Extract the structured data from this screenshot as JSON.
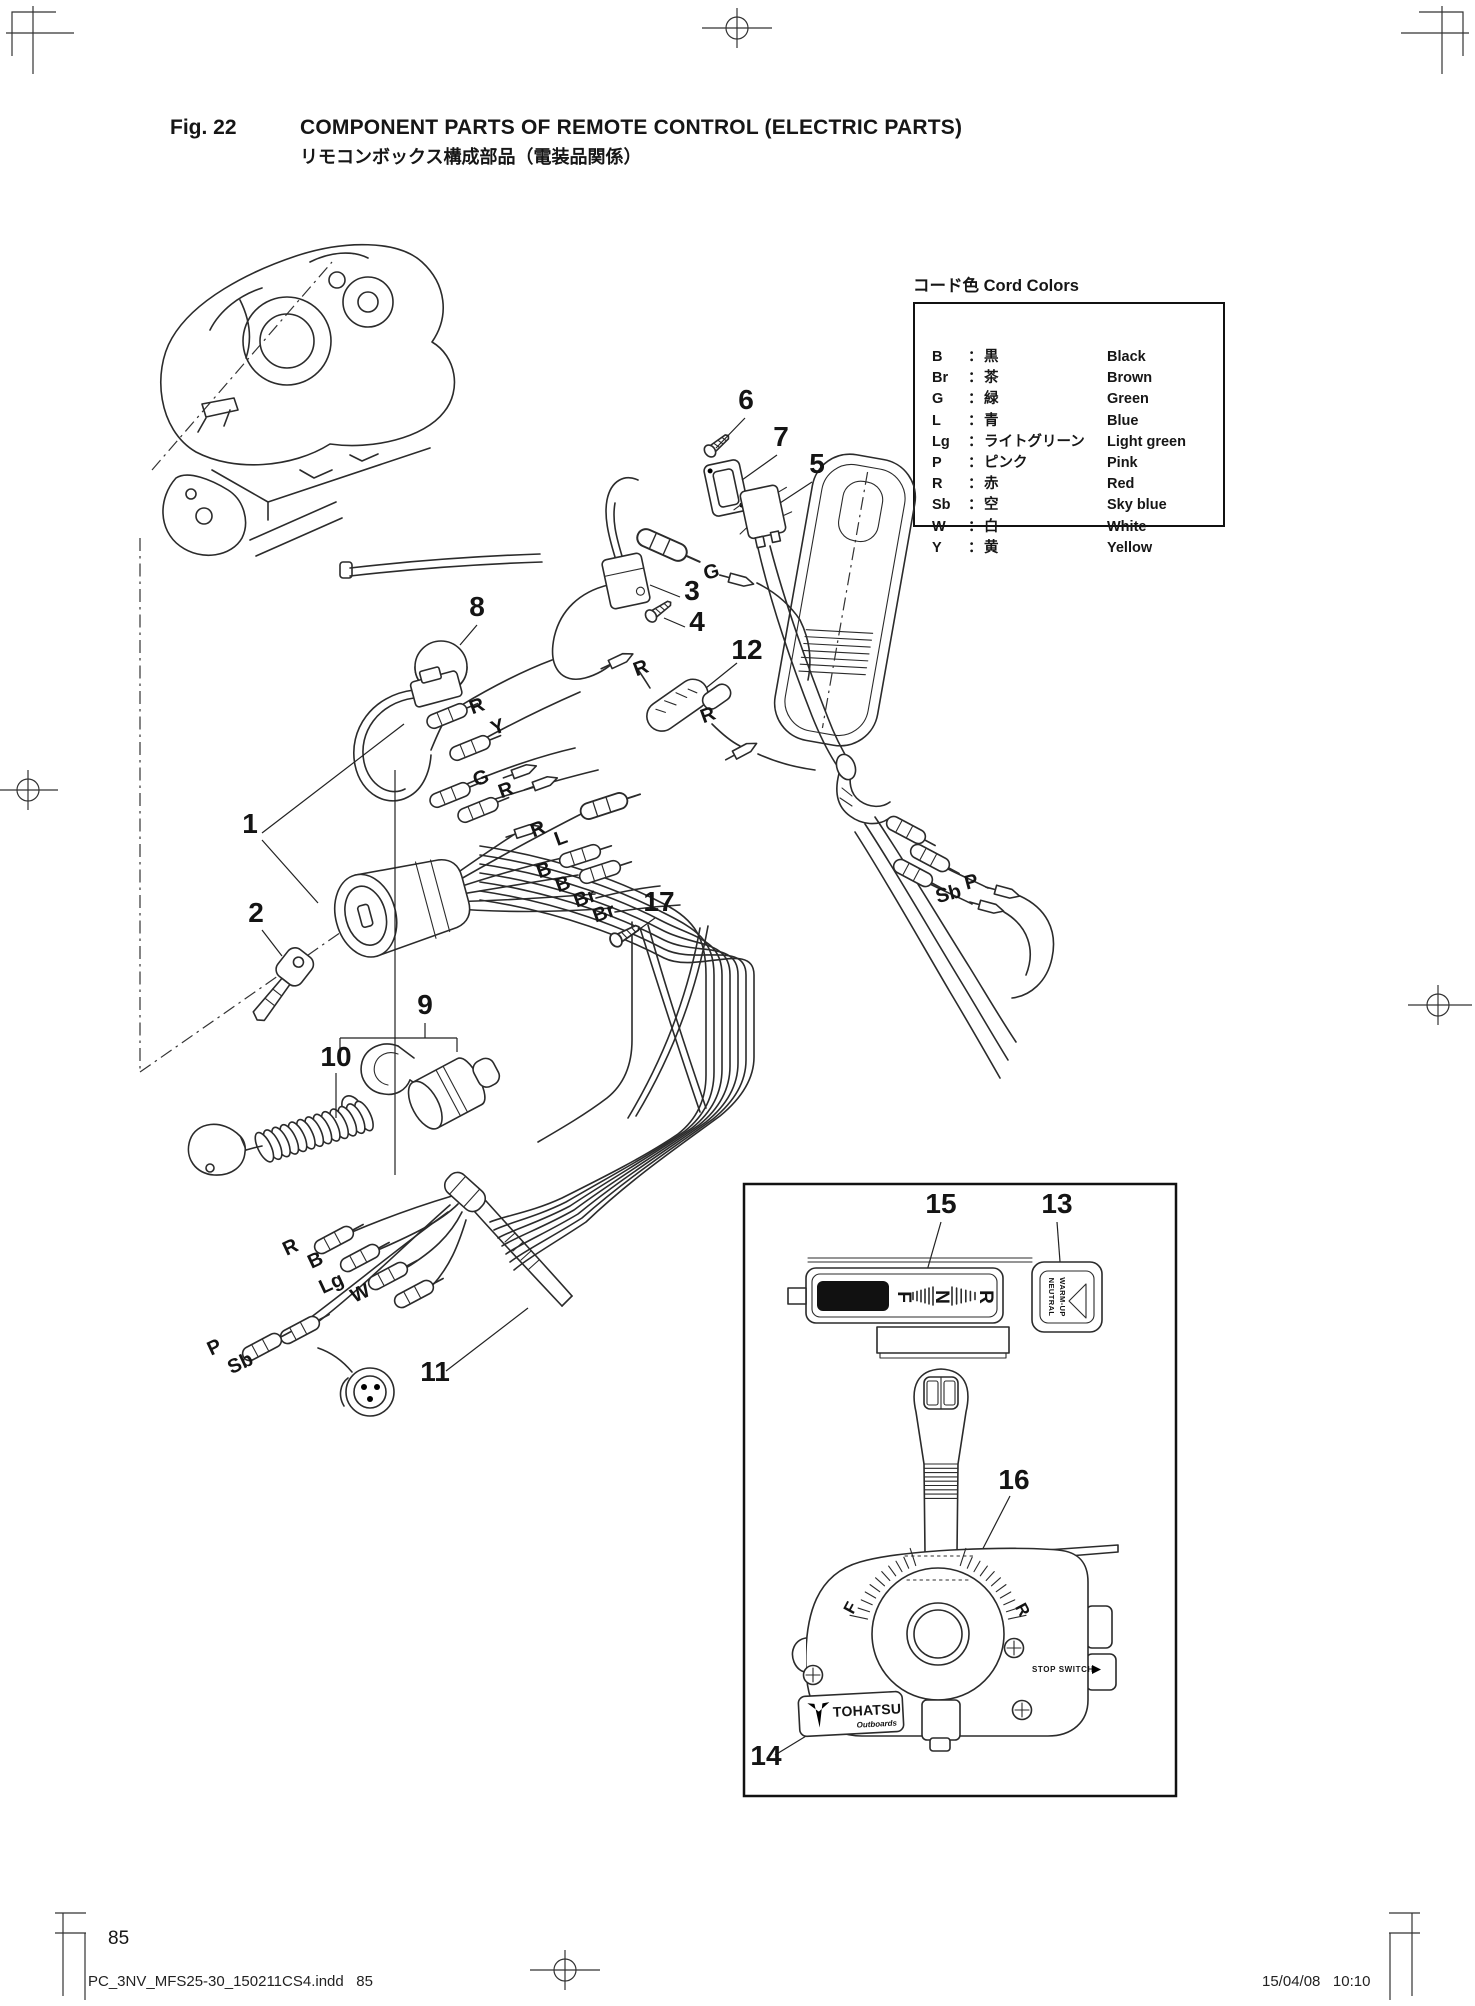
{
  "page": {
    "fig_label": "Fig. 22",
    "title": "COMPONENT PARTS OF REMOTE CONTROL (ELECTRIC PARTS)",
    "subtitle_jp": "リモコンボックス構成部品（電装品関係）",
    "page_number": "85",
    "footer_left": "PC_3NV_MFS25-30_150211CS4.indd   85",
    "footer_right": "15/04/08   10:10"
  },
  "cord_colors": {
    "title_jp": "コード色",
    "title_en": "Cord Colors",
    "sep": "：",
    "rows": [
      {
        "code": "B",
        "jp": "黒",
        "en": "Black"
      },
      {
        "code": "Br",
        "jp": "茶",
        "en": "Brown"
      },
      {
        "code": "G",
        "jp": "緑",
        "en": "Green"
      },
      {
        "code": "L",
        "jp": "青",
        "en": "Blue"
      },
      {
        "code": "Lg",
        "jp": "ライトグリーン",
        "en": "Light green"
      },
      {
        "code": "P",
        "jp": "ピンク",
        "en": "Pink"
      },
      {
        "code": "R",
        "jp": "赤",
        "en": "Red"
      },
      {
        "code": "Sb",
        "jp": "空",
        "en": "Sky blue"
      },
      {
        "code": "W",
        "jp": "白",
        "en": "White"
      },
      {
        "code": "Y",
        "jp": "黄",
        "en": "Yellow"
      }
    ]
  },
  "diagram": {
    "callouts": [
      {
        "n": "1",
        "x": 250,
        "y": 833
      },
      {
        "n": "2",
        "x": 256,
        "y": 922
      },
      {
        "n": "3",
        "x": 692,
        "y": 600
      },
      {
        "n": "4",
        "x": 697,
        "y": 631
      },
      {
        "n": "5",
        "x": 817,
        "y": 473
      },
      {
        "n": "6",
        "x": 746,
        "y": 409
      },
      {
        "n": "7",
        "x": 781,
        "y": 446
      },
      {
        "n": "8",
        "x": 477,
        "y": 616
      },
      {
        "n": "9",
        "x": 425,
        "y": 1014
      },
      {
        "n": "10",
        "x": 336,
        "y": 1066
      },
      {
        "n": "11",
        "x": 435,
        "y": 1381
      },
      {
        "n": "12",
        "x": 747,
        "y": 659
      },
      {
        "n": "13",
        "x": 1057,
        "y": 1213
      },
      {
        "n": "14",
        "x": 766,
        "y": 1765
      },
      {
        "n": "15",
        "x": 941,
        "y": 1213
      },
      {
        "n": "16",
        "x": 1014,
        "y": 1489
      },
      {
        "n": "17",
        "x": 659,
        "y": 911
      }
    ],
    "wire_labels": [
      {
        "t": "G",
        "x": 713,
        "y": 578,
        "r": -15
      },
      {
        "t": "R",
        "x": 479,
        "y": 712,
        "r": -20
      },
      {
        "t": "Y",
        "x": 500,
        "y": 733,
        "r": -20
      },
      {
        "t": "G",
        "x": 483,
        "y": 784,
        "r": -20
      },
      {
        "t": "R",
        "x": 508,
        "y": 796,
        "r": -20
      },
      {
        "t": "R",
        "x": 643,
        "y": 674,
        "r": -20
      },
      {
        "t": "R",
        "x": 710,
        "y": 721,
        "r": -20
      },
      {
        "t": "R",
        "x": 540,
        "y": 835,
        "r": -20
      },
      {
        "t": "L",
        "x": 563,
        "y": 844,
        "r": -20
      },
      {
        "t": "B",
        "x": 546,
        "y": 876,
        "r": -20
      },
      {
        "t": "B",
        "x": 565,
        "y": 890,
        "r": -20
      },
      {
        "t": "Br",
        "x": 587,
        "y": 904,
        "r": -20
      },
      {
        "t": "Br",
        "x": 606,
        "y": 919,
        "r": -20
      },
      {
        "t": "P",
        "x": 973,
        "y": 888,
        "r": -15
      },
      {
        "t": "Sb",
        "x": 950,
        "y": 900,
        "r": -15
      },
      {
        "t": "R",
        "x": 293,
        "y": 1253,
        "r": -25
      },
      {
        "t": "B",
        "x": 318,
        "y": 1266,
        "r": -25
      },
      {
        "t": "Lg",
        "x": 334,
        "y": 1289,
        "r": -25
      },
      {
        "t": "W",
        "x": 363,
        "y": 1299,
        "r": -25
      },
      {
        "t": "P",
        "x": 217,
        "y": 1353,
        "r": -25
      },
      {
        "t": "Sb",
        "x": 243,
        "y": 1369,
        "r": -25
      }
    ]
  },
  "inset": {
    "gear_letters": [
      {
        "t": "F",
        "x": 904,
        "y": 1297
      },
      {
        "t": "N",
        "x": 942,
        "y": 1297
      },
      {
        "t": "R",
        "x": 986,
        "y": 1297
      }
    ],
    "neutral_line1": "NEUTRAL",
    "neutral_line2": "WARM-UP",
    "stop_switch": "STOP SWITCH",
    "brand": "TOHATSU",
    "brand_sub": "Outboards",
    "box_letter_f": "F",
    "box_letter_r": "R"
  }
}
